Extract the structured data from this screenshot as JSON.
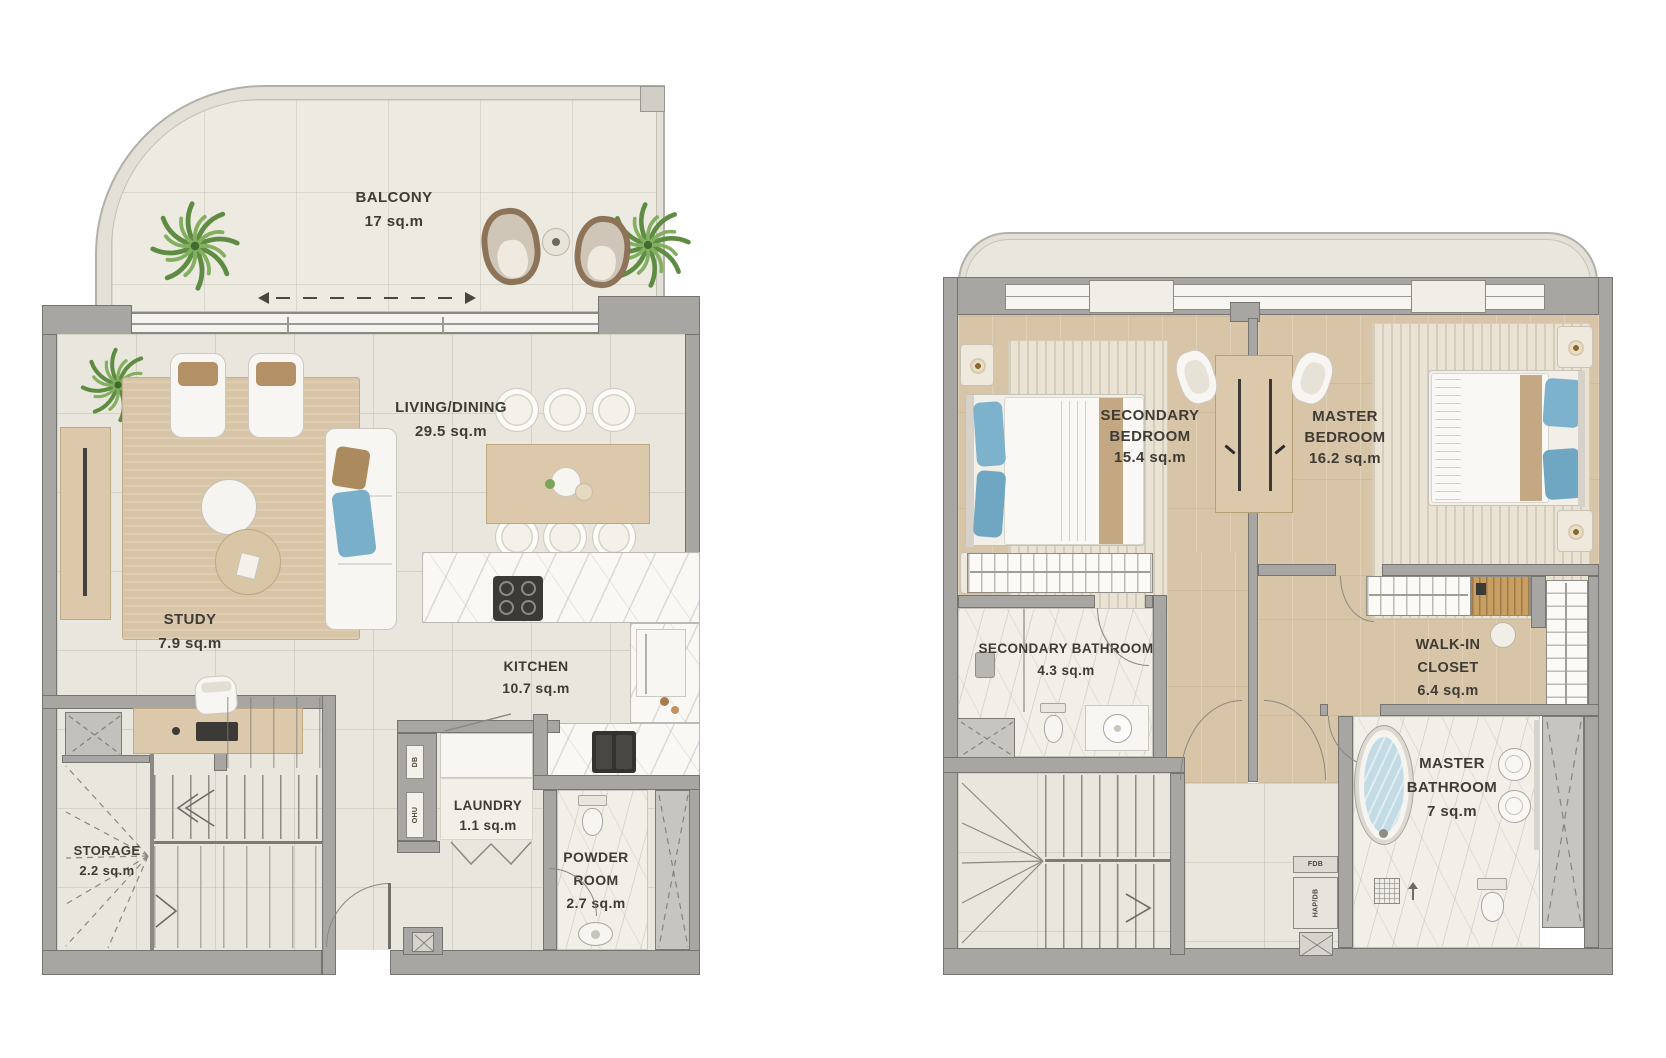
{
  "colors": {
    "wall_gray": "#a7a6a3",
    "wood_floor": "#d8c5a7",
    "tile_floor": "#e9e6dd",
    "marble": "#f2efe9",
    "accent_blue": "#7cb2cb",
    "plant_green": "#6f9e55",
    "label_text": "#3f3b35"
  },
  "floor1": {
    "balcony": {
      "lines": [
        "BALCONY"
      ],
      "area": "17 sq.m"
    },
    "living": {
      "lines": [
        "LIVING/DINING"
      ],
      "area": "29.5 sq.m"
    },
    "kitchen": {
      "lines": [
        "KITCHEN"
      ],
      "area": "10.7 sq.m"
    },
    "study": {
      "lines": [
        "STUDY"
      ],
      "area": "7.9 sq.m"
    },
    "storage": {
      "lines": [
        "STORAGE"
      ],
      "area": "2.2 sq.m"
    },
    "laundry": {
      "lines": [
        "LAUNDRY"
      ],
      "area": "1.1 sq.m"
    },
    "powder": {
      "lines": [
        "POWDER",
        "ROOM"
      ],
      "area": "2.7 sq.m"
    },
    "db_panel": "DB",
    "ohu_panel": "OHU"
  },
  "floor2": {
    "secondary_bedroom": {
      "lines": [
        "SECONDARY",
        "BEDROOM"
      ],
      "area": "15.4 sq.m"
    },
    "master_bedroom": {
      "lines": [
        "MASTER",
        "BEDROOM"
      ],
      "area": "16.2 sq.m"
    },
    "secondary_bathroom": {
      "lines": [
        "SECONDARY BATHROOM"
      ],
      "area": "4.3 sq.m"
    },
    "walkin_closet": {
      "lines": [
        "WALK-IN",
        "CLOSET"
      ],
      "area": "6.4 sq.m"
    },
    "master_bathroom": {
      "lines": [
        "MASTER",
        "BATHROOM"
      ],
      "area": "7 sq.m"
    },
    "fdb_panel": "FDB",
    "hapdb_panel": "HAP/DB"
  }
}
